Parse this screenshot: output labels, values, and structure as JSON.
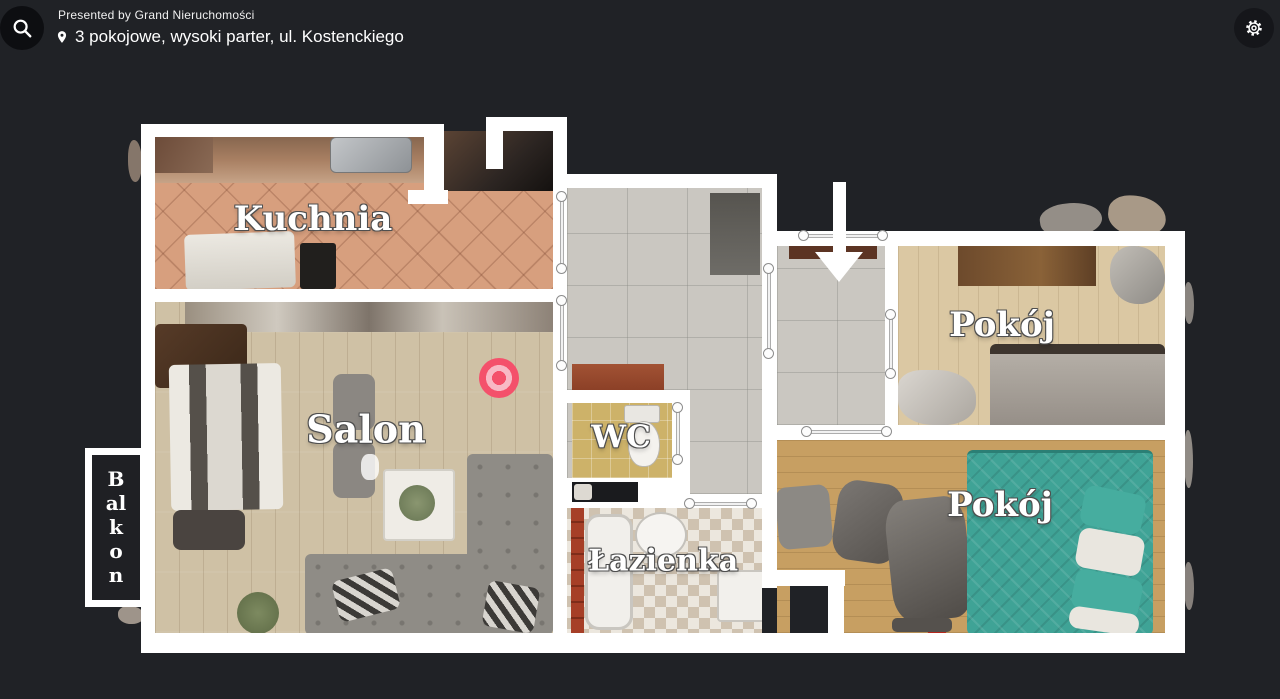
{
  "header": {
    "presented_by": "Presented by Grand Nieruchomości",
    "location_title": "3 pokojowe, wysoki parter, ul. Kostenckiego"
  },
  "icons": {
    "search": "magnifier-icon",
    "location": "map-pin-icon",
    "settings": "gear-icon",
    "entrance": "down-arrow-icon",
    "position": "bullseye-marker"
  },
  "floorplan": {
    "rooms": {
      "kitchen": {
        "label": "Kuchnia"
      },
      "living_room": {
        "label": "Salon"
      },
      "balcony": {
        "label": "Balkon"
      },
      "wc": {
        "label": "WC"
      },
      "bathroom": {
        "label": "Łazienka"
      },
      "bedroom_top": {
        "label": "Pokój"
      },
      "bedroom_bottom": {
        "label": "Pokój"
      }
    },
    "colors": {
      "walls": "#ffffff",
      "marker": "#f4516b",
      "background": "#202226"
    }
  }
}
